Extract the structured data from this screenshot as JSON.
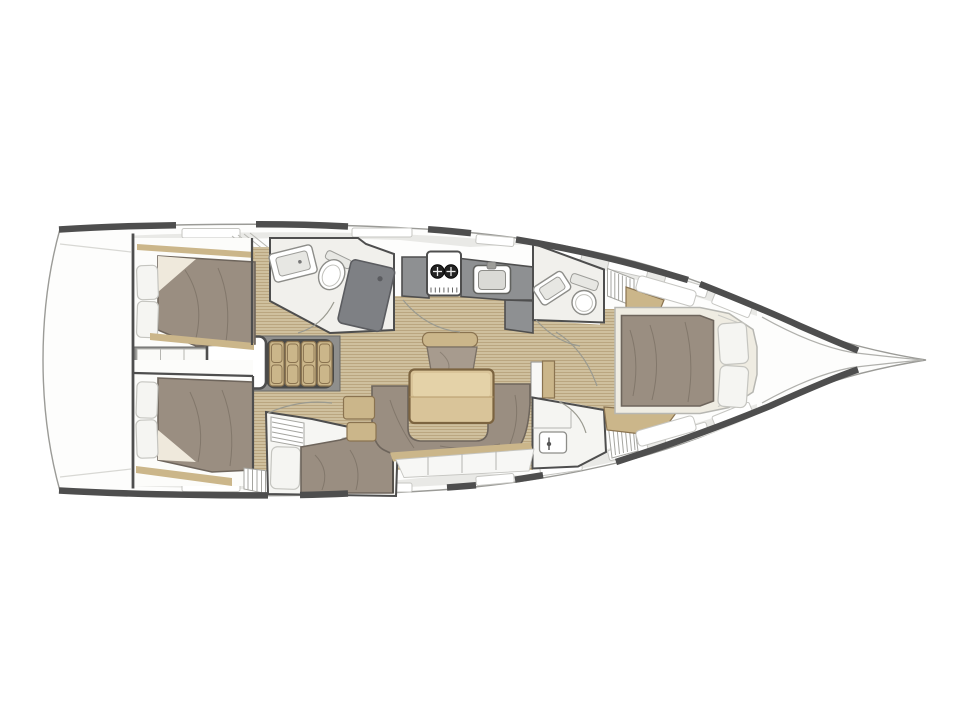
{
  "palette": {
    "hull-dark": "#4e4e4e",
    "hull-line": "#9b9b97",
    "deck": "#e9e9e6",
    "room": "#f1f0ec",
    "teak": "#cfc09e",
    "teak-line": "#b49f78",
    "wood": "#cbb68a",
    "wood-dark": "#8a7350",
    "table": "#d9c499",
    "mattress": "#9a8e81",
    "mattress-line": "#6e655c",
    "cushion": "#a79b8e",
    "pillow": "#f5f5f2",
    "counter": "#8e9092",
    "shower": "#7e8084",
    "structure": "#8f8f8d",
    "wall": "#4e4e4e",
    "arc": "#9a9a90",
    "hatch-line": "#c6c6c2",
    "paper": "#ffffff"
  },
  "plan": {
    "view": "top-down interior layout of a monohull sailing yacht",
    "bow_direction": "right",
    "rooms": {
      "hull": {
        "name": "hull-and-deck"
      },
      "aftCabinPort": {
        "name": "aft-cabin-port",
        "furniture": [
          "double-berth",
          "two-pillows",
          "wood-trim"
        ]
      },
      "aftCabinStarboard": {
        "name": "aft-cabin-starboard",
        "furniture": [
          "double-berth",
          "two-pillows",
          "wood-trim"
        ]
      },
      "midCabin": {
        "name": "mid-cabin-starboard",
        "furniture": [
          "single-berth",
          "pillow",
          "slatted-shelf"
        ]
      },
      "companionway": {
        "name": "companionway",
        "furniture": [
          "four-step-stairs",
          "engine-box",
          "lockers"
        ]
      },
      "aftHead": {
        "name": "aft-head-port",
        "furniture": [
          "sink",
          "toilet",
          "shower-tray"
        ]
      },
      "galley": {
        "name": "galley",
        "furniture": [
          "l-shaped-counter",
          "two-burner-stove",
          "sink"
        ]
      },
      "fwdHeadPort": {
        "name": "forward-head-port",
        "furniture": [
          "sink",
          "toilet",
          "slatted-grate"
        ]
      },
      "fwdHeadStarboard": {
        "name": "forward-head-starboard",
        "furniture": [
          "sink",
          "slatted-grate"
        ]
      },
      "saloon": {
        "name": "saloon",
        "furniture": [
          "dining-table",
          "u-shaped-settee",
          "armchair",
          "side-step-boxes",
          "locker-band"
        ]
      },
      "forwardCabin": {
        "name": "forward-cabin",
        "furniture": [
          "island-double-berth",
          "two-pillows",
          "hull-lockers",
          "dressing-benches"
        ]
      },
      "bow": {
        "name": "bow-locker-and-stem"
      }
    }
  }
}
